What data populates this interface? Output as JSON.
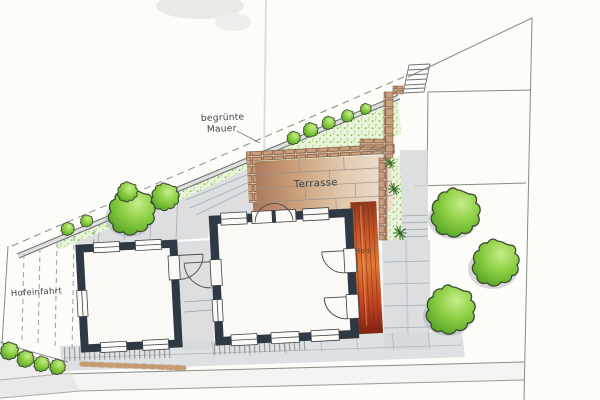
{
  "labels": {
    "greened_wall_line1": "begrünte",
    "greened_wall_line2": "Mauer",
    "terrace": "Terrasse",
    "wood_deck": "Holz",
    "driveway": "Hofeinfahrt"
  },
  "palette": {
    "paper": "#fcfcf9",
    "building_wall_dark": "#2e3944",
    "paving_gray": "#d3d6da",
    "terrace_brown": "#9b5f3e",
    "terrace_tan": "#dcc0a0",
    "brick": "#c99f7f",
    "wood_deck_orange": "#e07b35",
    "wood_deck_red": "#8e3a1e",
    "foliage_light": "#c6ed8a",
    "foliage_green": "#8ed045",
    "foliage_dark": "#4f9d22",
    "stipple_green": "#6fbf3a",
    "ink": "#3f3f45",
    "boundary_line": "#8a8a85",
    "paper_crease": "#c2ced6"
  }
}
